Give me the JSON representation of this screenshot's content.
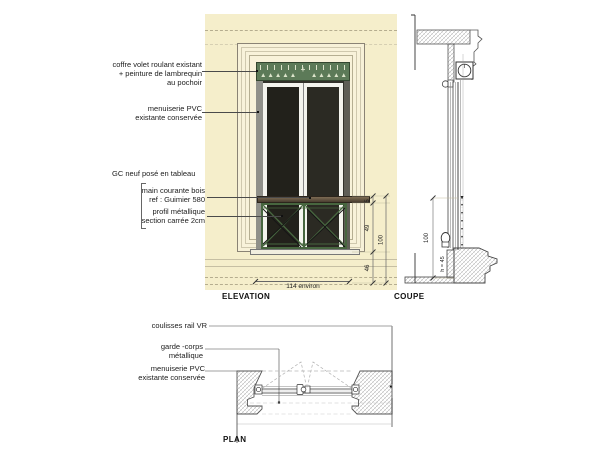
{
  "titles": {
    "elevation": "ELEVATION",
    "coupe": "COUPE",
    "plan": "PLAN"
  },
  "annotations": {
    "coffre": {
      "line1": "coffre volet roulant existant",
      "line2": "+ peinture de lambrequin",
      "line3": "au pochoir"
    },
    "menuiserie_elev": {
      "line1": "menuiserie PVC",
      "line2": "existante conservée"
    },
    "gc": "GC neuf posé en tableau",
    "main_courante": {
      "line1": "main courante bois",
      "line2": "ref : Guimier 580"
    },
    "profil": {
      "line1": "profil métallique",
      "line2": "section carrée 2cm"
    },
    "coulisses": "coulisses  rail VR",
    "garde_corps": {
      "line1": "garde -corps",
      "line2": "métallique"
    },
    "menuiserie_plan": {
      "line1": "menuiserie PVC",
      "line2": "existante conservée"
    }
  },
  "dimensions": {
    "handrail": "5",
    "railing": "49",
    "allege": "46",
    "total": "100",
    "width": "114 environ",
    "coupe_total": "100",
    "coupe_sill": "h = 45"
  },
  "deco": {
    "triangles_left": "▲▲▲▲▲",
    "triangles_right": "▲▲▲▲▲",
    "center_motif": "+"
  },
  "colors": {
    "wall_cream": "#f5eecb",
    "molding_cream": "#f8f2da",
    "lambrequin_green": "#5c7a58",
    "railing_green": "#47663f",
    "handrail_brown": "#6b5844",
    "glass_dark": "#28271f",
    "hatch_gray": "#9a9a9a"
  }
}
